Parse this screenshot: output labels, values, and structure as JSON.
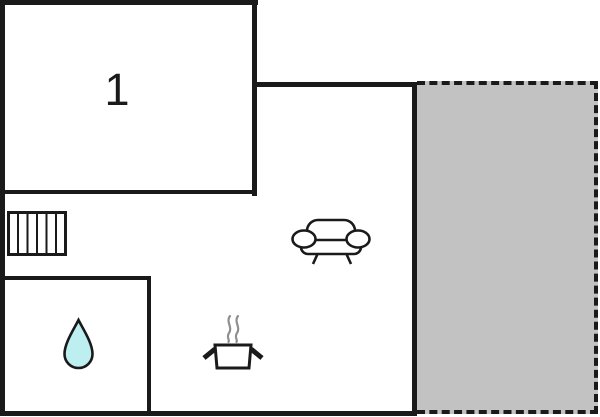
{
  "floorplan": {
    "room_label": "1",
    "colors": {
      "wall": "#1a1a1a",
      "icon_stroke": "#1a1a1a",
      "terrace_fill": "#c2c2c2",
      "drop_fill": "#bdeef0",
      "steam": "#8f8f8f",
      "background": "#ffffff",
      "icon_fill": "#ffffff"
    },
    "icons": {
      "radiator": "radiator-icon",
      "sofa": "sofa-icon",
      "cooking_pot": "steaming-pot-icon",
      "water_drop": "water-drop-icon"
    },
    "areas": {
      "room1": "room-1",
      "living": "living-area",
      "bath": "bath-area",
      "terrace": "terrace-area"
    }
  }
}
